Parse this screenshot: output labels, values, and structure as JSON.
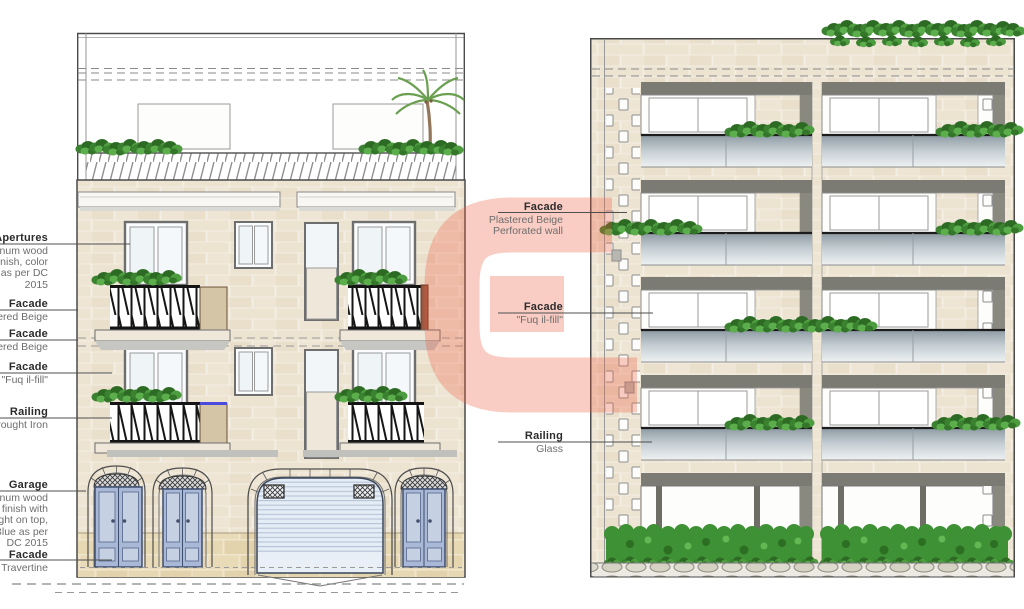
{
  "watermark": {
    "letter": "G",
    "color": "#F0583C"
  },
  "annotations": {
    "left": [
      {
        "title": "Apertures",
        "lines": [
          "ninum wood",
          "finish, color",
          "e as per DC",
          "2015"
        ]
      },
      {
        "title": "Facade",
        "lines": [
          "tered Beige"
        ]
      },
      {
        "title": "Facade",
        "lines": [
          "tered Beige"
        ]
      },
      {
        "title": "Facade",
        "lines": [
          "\"Fuq il-fill\""
        ]
      },
      {
        "title": "Railing",
        "lines": [
          "Wrought Iron"
        ]
      },
      {
        "title": "Garage",
        "lines": [
          "ninum wood",
          "e finish with",
          "light on top,",
          "Blue as per",
          "DC 2015"
        ]
      },
      {
        "title": "Facade",
        "lines": [
          "Travertine"
        ]
      }
    ],
    "middle": [
      {
        "title": "Facade",
        "lines": [
          "Plastered Beige",
          "Perforated wall"
        ]
      },
      {
        "title": "Facade",
        "lines": [
          "\"Fuq il-fill\""
        ]
      },
      {
        "title": "Railing",
        "lines": [
          "Glass"
        ]
      }
    ]
  },
  "colors": {
    "facade_brick": "#ECE3D1",
    "travertine": "#E7D8B4",
    "door_blue": "#A9B8D6",
    "garage_shutter": "#E4ECF6",
    "iron_railing": "#161616",
    "glass_railing": "#8E9AA4",
    "soffit_gray": "#7C7B73",
    "plant_green": "#3A822F",
    "watermark_pink": "#F0583C"
  }
}
